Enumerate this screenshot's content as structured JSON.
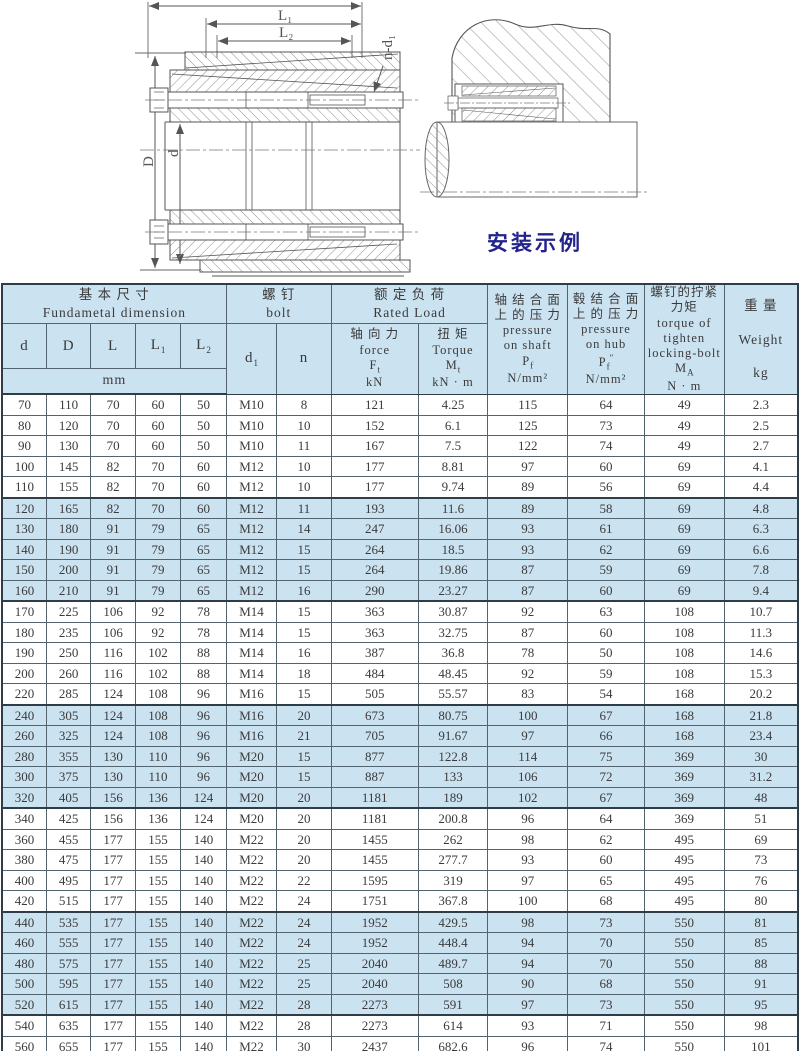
{
  "drawing": {
    "caption": "安装示例",
    "labels": {
      "L1": "L₁",
      "L2": "L₂",
      "n_d1": "n-d₁",
      "d": "d",
      "D": "D"
    }
  },
  "colors": {
    "band_blue": "#cbe2f0",
    "caption_navy": "#23238c",
    "border_dark": "#2e3d46"
  },
  "table": {
    "groups": {
      "basic": [
        "基 本 尺 寸",
        "Fundametal dimension"
      ],
      "bolt": [
        "螺 钉",
        "bolt"
      ],
      "rated": [
        "额 定 负 荷",
        "Rated Load"
      ]
    },
    "columns": {
      "d": "d",
      "D": "D",
      "L": "L",
      "L1": "L~1~",
      "L2": "L~2~",
      "unit_mm": "mm",
      "d1": "d~1~",
      "n": "n",
      "force": [
        "轴 向 力",
        "force",
        "F~t~",
        "kN"
      ],
      "torque": [
        "扭 矩",
        "Torque",
        "M~t~",
        "kN · m"
      ],
      "pressure_shaft": [
        "轴 结 合 面",
        "上 的 压 力",
        "pressure",
        "on shaft",
        "P~f~",
        "N/mm²"
      ],
      "pressure_hub": [
        "毂 结 合 面",
        "上 的 压 力",
        "pressure",
        "on hub",
        "P~f~^″^",
        "N/mm²"
      ],
      "tighten_torque": [
        "螺钉的拧紧",
        "力矩",
        "torque of",
        "tighten",
        "locking-bolt",
        "M~A~",
        "N · m"
      ],
      "weight": [
        "重 量",
        "Weight",
        "kg"
      ]
    },
    "rows": [
      [
        "70",
        "110",
        "70",
        "60",
        "50",
        "M10",
        "8",
        "121",
        "4.25",
        "115",
        "64",
        "49",
        "2.3"
      ],
      [
        "80",
        "120",
        "70",
        "60",
        "50",
        "M10",
        "10",
        "152",
        "6.1",
        "125",
        "73",
        "49",
        "2.5"
      ],
      [
        "90",
        "130",
        "70",
        "60",
        "50",
        "M10",
        "11",
        "167",
        "7.5",
        "122",
        "74",
        "49",
        "2.7"
      ],
      [
        "100",
        "145",
        "82",
        "70",
        "60",
        "M12",
        "10",
        "177",
        "8.81",
        "97",
        "60",
        "69",
        "4.1"
      ],
      [
        "110",
        "155",
        "82",
        "70",
        "60",
        "M12",
        "10",
        "177",
        "9.74",
        "89",
        "56",
        "69",
        "4.4"
      ],
      [
        "120",
        "165",
        "82",
        "70",
        "60",
        "M12",
        "11",
        "193",
        "11.6",
        "89",
        "58",
        "69",
        "4.8"
      ],
      [
        "130",
        "180",
        "91",
        "79",
        "65",
        "M12",
        "14",
        "247",
        "16.06",
        "93",
        "61",
        "69",
        "6.3"
      ],
      [
        "140",
        "190",
        "91",
        "79",
        "65",
        "M12",
        "15",
        "264",
        "18.5",
        "93",
        "62",
        "69",
        "6.6"
      ],
      [
        "150",
        "200",
        "91",
        "79",
        "65",
        "M12",
        "15",
        "264",
        "19.86",
        "87",
        "59",
        "69",
        "7.8"
      ],
      [
        "160",
        "210",
        "91",
        "79",
        "65",
        "M12",
        "16",
        "290",
        "23.27",
        "87",
        "60",
        "69",
        "9.4"
      ],
      [
        "170",
        "225",
        "106",
        "92",
        "78",
        "M14",
        "15",
        "363",
        "30.87",
        "92",
        "63",
        "108",
        "10.7"
      ],
      [
        "180",
        "235",
        "106",
        "92",
        "78",
        "M14",
        "15",
        "363",
        "32.75",
        "87",
        "60",
        "108",
        "11.3"
      ],
      [
        "190",
        "250",
        "116",
        "102",
        "88",
        "M14",
        "16",
        "387",
        "36.8",
        "78",
        "50",
        "108",
        "14.6"
      ],
      [
        "200",
        "260",
        "116",
        "102",
        "88",
        "M14",
        "18",
        "484",
        "48.45",
        "92",
        "59",
        "108",
        "15.3"
      ],
      [
        "220",
        "285",
        "124",
        "108",
        "96",
        "M16",
        "15",
        "505",
        "55.57",
        "83",
        "54",
        "168",
        "20.2"
      ],
      [
        "240",
        "305",
        "124",
        "108",
        "96",
        "M16",
        "20",
        "673",
        "80.75",
        "100",
        "67",
        "168",
        "21.8"
      ],
      [
        "260",
        "325",
        "124",
        "108",
        "96",
        "M16",
        "21",
        "705",
        "91.67",
        "97",
        "66",
        "168",
        "23.4"
      ],
      [
        "280",
        "355",
        "130",
        "110",
        "96",
        "M20",
        "15",
        "877",
        "122.8",
        "114",
        "75",
        "369",
        "30"
      ],
      [
        "300",
        "375",
        "130",
        "110",
        "96",
        "M20",
        "15",
        "887",
        "133",
        "106",
        "72",
        "369",
        "31.2"
      ],
      [
        "320",
        "405",
        "156",
        "136",
        "124",
        "M20",
        "20",
        "1181",
        "189",
        "102",
        "67",
        "369",
        "48"
      ],
      [
        "340",
        "425",
        "156",
        "136",
        "124",
        "M20",
        "20",
        "1181",
        "200.8",
        "96",
        "64",
        "369",
        "51"
      ],
      [
        "360",
        "455",
        "177",
        "155",
        "140",
        "M22",
        "20",
        "1455",
        "262",
        "98",
        "62",
        "495",
        "69"
      ],
      [
        "380",
        "475",
        "177",
        "155",
        "140",
        "M22",
        "20",
        "1455",
        "277.7",
        "93",
        "60",
        "495",
        "73"
      ],
      [
        "400",
        "495",
        "177",
        "155",
        "140",
        "M22",
        "22",
        "1595",
        "319",
        "97",
        "65",
        "495",
        "76"
      ],
      [
        "420",
        "515",
        "177",
        "155",
        "140",
        "M22",
        "24",
        "1751",
        "367.8",
        "100",
        "68",
        "495",
        "80"
      ],
      [
        "440",
        "535",
        "177",
        "155",
        "140",
        "M22",
        "24",
        "1952",
        "429.5",
        "98",
        "73",
        "550",
        "81"
      ],
      [
        "460",
        "555",
        "177",
        "155",
        "140",
        "M22",
        "24",
        "1952",
        "448.4",
        "94",
        "70",
        "550",
        "85"
      ],
      [
        "480",
        "575",
        "177",
        "155",
        "140",
        "M22",
        "25",
        "2040",
        "489.7",
        "94",
        "70",
        "550",
        "88"
      ],
      [
        "500",
        "595",
        "177",
        "155",
        "140",
        "M22",
        "25",
        "2040",
        "508",
        "90",
        "68",
        "550",
        "91"
      ],
      [
        "520",
        "615",
        "177",
        "155",
        "140",
        "M22",
        "28",
        "2273",
        "591",
        "97",
        "73",
        "550",
        "95"
      ],
      [
        "540",
        "635",
        "177",
        "155",
        "140",
        "M22",
        "28",
        "2273",
        "614",
        "93",
        "71",
        "550",
        "98"
      ],
      [
        "560",
        "655",
        "177",
        "155",
        "140",
        "M22",
        "30",
        "2437",
        "682.6",
        "96",
        "74",
        "550",
        "101"
      ],
      [
        "580",
        "675",
        "177",
        "155",
        "140",
        "M22",
        "30",
        "2437",
        "707.4",
        "93",
        "72",
        "550",
        "104"
      ],
      [
        "600",
        "695",
        "177",
        "155",
        "140",
        "M22",
        "30",
        "2437",
        "731.6",
        "90",
        "70",
        "550",
        "108"
      ]
    ]
  }
}
